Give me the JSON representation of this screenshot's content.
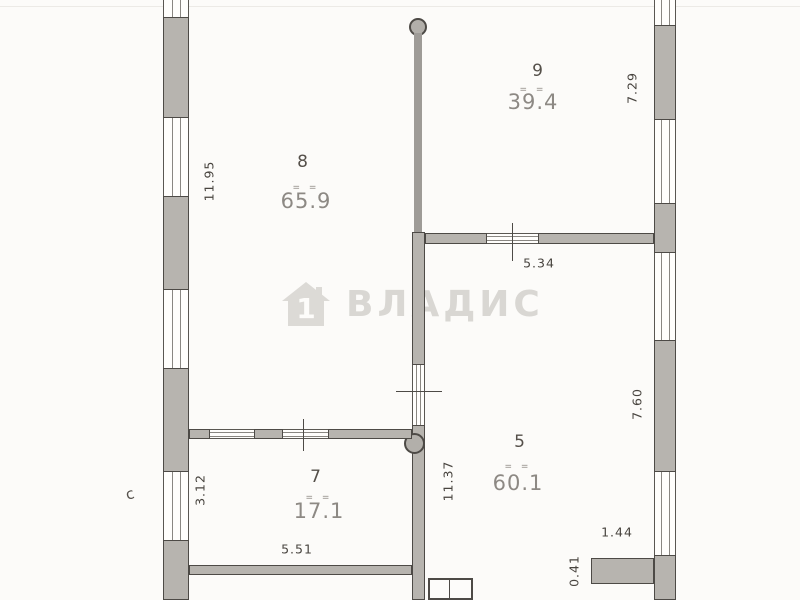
{
  "watermark": {
    "brand_text": "ВЛАДИС",
    "icon": "house-number-1-icon",
    "icon_digit": "1"
  },
  "rooms": [
    {
      "number": "9",
      "area": "39.4",
      "strike": "= ="
    },
    {
      "number": "8",
      "area": "65.9",
      "strike": "= ="
    },
    {
      "number": "7",
      "area": "17.1",
      "strike": "= ="
    },
    {
      "number": "5",
      "area": "60.1",
      "strike": "= ="
    }
  ],
  "dimensions": [
    {
      "value": "11.95",
      "orientation": "vertical",
      "along": "left-wall-room-8"
    },
    {
      "value": "7.29",
      "orientation": "vertical",
      "along": "right-wall-room-9"
    },
    {
      "value": "5.34",
      "orientation": "horizontal",
      "along": "wall-room-9-room-5"
    },
    {
      "value": "3.12",
      "orientation": "vertical",
      "along": "left-wall-room-7"
    },
    {
      "value": "5.51",
      "orientation": "horizontal",
      "along": "bottom-wall-room-7"
    },
    {
      "value": "11.37",
      "orientation": "vertical",
      "along": "center-wall-room-5"
    },
    {
      "value": "7.60",
      "orientation": "vertical",
      "along": "right-wall-room-5"
    },
    {
      "value": "1.44",
      "orientation": "horizontal",
      "along": "stub-wall-bottom-right"
    },
    {
      "value": "0.41",
      "orientation": "vertical",
      "along": "stub-wall-bottom-right"
    }
  ],
  "marks": {
    "curve": "c"
  },
  "colors": {
    "paper": "#fcfbf9",
    "wall_fill": "#b7b4af",
    "line": "#4d4a46",
    "area_text": "#8d8984",
    "dim_text": "#48443f",
    "watermark": "#d9d7d3"
  }
}
